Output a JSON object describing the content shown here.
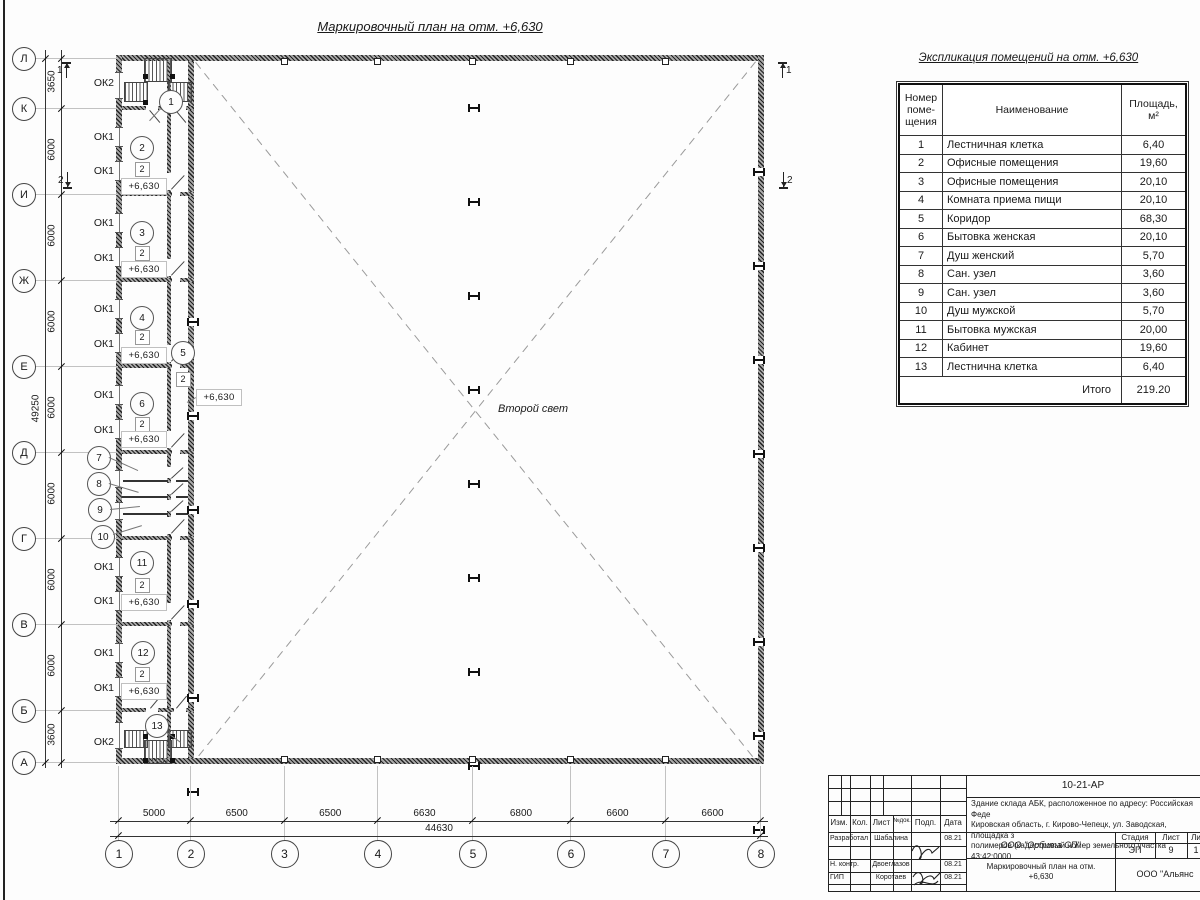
{
  "drawing": {
    "title": "Маркировочный план на отм. +6,630",
    "second_light": "Второй свет"
  },
  "schedule": {
    "title": "Экспликация помещений на отм. +6,630",
    "col_headers": [
      "Номер\nпоме-\nщения",
      "Наименование",
      "Площадь,\nм²"
    ],
    "rows": [
      [
        "1",
        "Лестничная клетка",
        "6,40"
      ],
      [
        "2",
        "Офисные помещения",
        "19,60"
      ],
      [
        "3",
        "Офисные помещения",
        "20,10"
      ],
      [
        "4",
        "Комната приема пищи",
        "20,10"
      ],
      [
        "5",
        "Коридор",
        "68,30"
      ],
      [
        "6",
        "Бытовка женская",
        "20,10"
      ],
      [
        "7",
        "Душ женский",
        "5,70"
      ],
      [
        "8",
        "Сан. узел",
        "3,60"
      ],
      [
        "9",
        "Сан. узел",
        "3,60"
      ],
      [
        "10",
        "Душ мужской",
        "5,70"
      ],
      [
        "11",
        "Бытовка мужская",
        "20,00"
      ],
      [
        "12",
        "Кабинет",
        "19,60"
      ],
      [
        "13",
        "Лестнична клетка",
        "6,40"
      ]
    ],
    "total_label": "Итого",
    "total_value": "219.20"
  },
  "axes": {
    "letters": [
      {
        "label": "Л",
        "y": 58
      },
      {
        "label": "К",
        "y": 108
      },
      {
        "label": "И",
        "y": 194
      },
      {
        "label": "Ж",
        "y": 280
      },
      {
        "label": "Е",
        "y": 366
      },
      {
        "label": "Д",
        "y": 452
      },
      {
        "label": "Г",
        "y": 538
      },
      {
        "label": "В",
        "y": 624
      },
      {
        "label": "Б",
        "y": 710
      },
      {
        "label": "А",
        "y": 762
      }
    ],
    "numbers": [
      {
        "label": "1",
        "x": 118
      },
      {
        "label": "2",
        "x": 190
      },
      {
        "label": "3",
        "x": 283.5
      },
      {
        "label": "4",
        "x": 377
      },
      {
        "label": "5",
        "x": 472
      },
      {
        "label": "6",
        "x": 570
      },
      {
        "label": "7",
        "x": 665
      },
      {
        "label": "8",
        "x": 760
      }
    ]
  },
  "dimensions": {
    "left_chain": [
      "3650",
      "6000",
      "6000",
      "6000",
      "6000",
      "6000",
      "6000",
      "6000",
      "3600"
    ],
    "left_total": "49250",
    "bottom_chain": [
      "5000",
      "6500",
      "6500",
      "6630",
      "6800",
      "6600",
      "6600"
    ],
    "bottom_total": "44630"
  },
  "plan_labels": {
    "window_labels": [
      {
        "text": "ОК2",
        "y": 83
      },
      {
        "text": "ОК1",
        "y": 137
      },
      {
        "text": "ОК1",
        "y": 171
      },
      {
        "text": "ОК1",
        "y": 223
      },
      {
        "text": "ОК1",
        "y": 258
      },
      {
        "text": "ОК1",
        "y": 309
      },
      {
        "text": "ОК1",
        "y": 344
      },
      {
        "text": "ОК1",
        "y": 395
      },
      {
        "text": "ОК1",
        "y": 430
      },
      {
        "text": "ОК1",
        "y": 567
      },
      {
        "text": "ОК1",
        "y": 601
      },
      {
        "text": "ОК1",
        "y": 653
      },
      {
        "text": "ОК1",
        "y": 688
      },
      {
        "text": "ОК2",
        "y": 742
      }
    ],
    "room_circles": [
      {
        "n": "1",
        "x": 170,
        "y": 101
      },
      {
        "n": "2",
        "x": 141,
        "y": 147
      },
      {
        "n": "3",
        "x": 141,
        "y": 232
      },
      {
        "n": "4",
        "x": 141,
        "y": 317
      },
      {
        "n": "5",
        "x": 182,
        "y": 352
      },
      {
        "n": "6",
        "x": 141,
        "y": 403
      },
      {
        "n": "7",
        "x": 98,
        "y": 457
      },
      {
        "n": "8",
        "x": 98,
        "y": 483
      },
      {
        "n": "9",
        "x": 99,
        "y": 509
      },
      {
        "n": "10",
        "x": 102,
        "y": 536
      },
      {
        "n": "11",
        "x": 141,
        "y": 562
      },
      {
        "n": "12",
        "x": 142,
        "y": 652
      },
      {
        "n": "13",
        "x": 156,
        "y": 725
      }
    ],
    "door_squares": [
      {
        "text": "2",
        "x": 141,
        "y": 168
      },
      {
        "text": "2",
        "x": 141,
        "y": 252
      },
      {
        "text": "2",
        "x": 141,
        "y": 336
      },
      {
        "text": "2",
        "x": 182,
        "y": 378
      },
      {
        "text": "2",
        "x": 141,
        "y": 423
      },
      {
        "text": "2",
        "x": 141,
        "y": 584
      },
      {
        "text": "2",
        "x": 141,
        "y": 673
      }
    ],
    "elevations": [
      {
        "text": "+6,630",
        "x": 143,
        "y": 185
      },
      {
        "text": "+6,630",
        "x": 143,
        "y": 268
      },
      {
        "text": "+6,630",
        "x": 143,
        "y": 354
      },
      {
        "text": "+6,630",
        "x": 143,
        "y": 438
      },
      {
        "text": "+6,630",
        "x": 143,
        "y": 601
      },
      {
        "text": "+6,630",
        "x": 143,
        "y": 690
      },
      {
        "text": "+6,630",
        "x": 218,
        "y": 396
      }
    ],
    "section_marks": [
      {
        "label": "1",
        "x": 66,
        "y": 70,
        "bar": "top",
        "digit": "left"
      },
      {
        "label": "2",
        "x": 67,
        "y": 180,
        "bar": "bottom",
        "digit": "left"
      },
      {
        "label": "1",
        "x": 782,
        "y": 70,
        "bar": "top",
        "digit": "right"
      },
      {
        "label": "2",
        "x": 783,
        "y": 180,
        "bar": "bottom",
        "digit": "right"
      }
    ]
  },
  "titleblock": {
    "doc_number": "10-21-АР",
    "description": "Здание склада АБК, расположенное по адресу: Российская Феде\nКировская область, г. Кирово-Чепецк, ул. Заводская, площадка з\nполимеров (кадастровый номер земельного участка 43:42:0000",
    "header_cols": [
      "Изм.",
      "Кол.",
      "Лист",
      "№док.",
      "Подп.",
      "Дата"
    ],
    "sign_rows": [
      {
        "role": "Разработал",
        "name": "Шабалина",
        "date": "08.21"
      },
      {
        "role": "Н. контр.",
        "name": "Двоеглазов",
        "date": "08.21"
      },
      {
        "role": "ГИП",
        "name": "Коротаев",
        "date": "08.21"
      }
    ],
    "org": "ООО \"Орбита СП\"",
    "stage_cols": [
      "Стадия",
      "Лист",
      "Ли"
    ],
    "stage_vals": [
      "ЭП",
      "9",
      "1"
    ],
    "sheet_title": "Маркировочный план на отм.\n+6,630",
    "org2": "ООО \"Альянс"
  }
}
